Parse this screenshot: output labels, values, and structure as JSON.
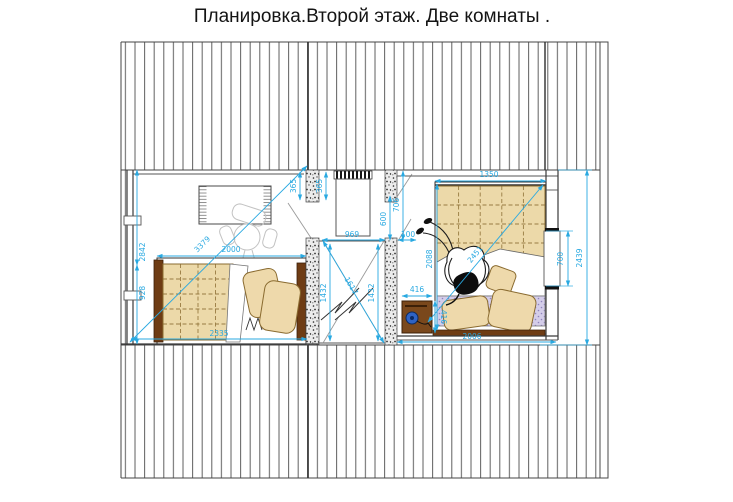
{
  "title": "Планировка.Второй этаж. Две комнаты  .",
  "colors": {
    "dimension_accent": "#29a9e1",
    "wood_furniture": "#7a481c",
    "quilt_tan": "#ecd9a9",
    "mattress_lavender": "#d4cde9",
    "drawing_line": "#444444"
  },
  "dims": {
    "d2842": "2842",
    "d928": "928",
    "d2335": "2335",
    "d2000": "2000",
    "d3379": "3379",
    "d365a": "365",
    "d365b": "365",
    "d969": "969",
    "d600": "600",
    "d706": "706",
    "d100": "100",
    "d1432a": "1432",
    "d1432b": "1432",
    "d1617": "1617",
    "d1350": "1350",
    "d2088": "2088",
    "d2451": "2451",
    "d416a": "416",
    "d416b": "416",
    "d2006": "2006",
    "d700": "700",
    "d2439": "2439"
  }
}
